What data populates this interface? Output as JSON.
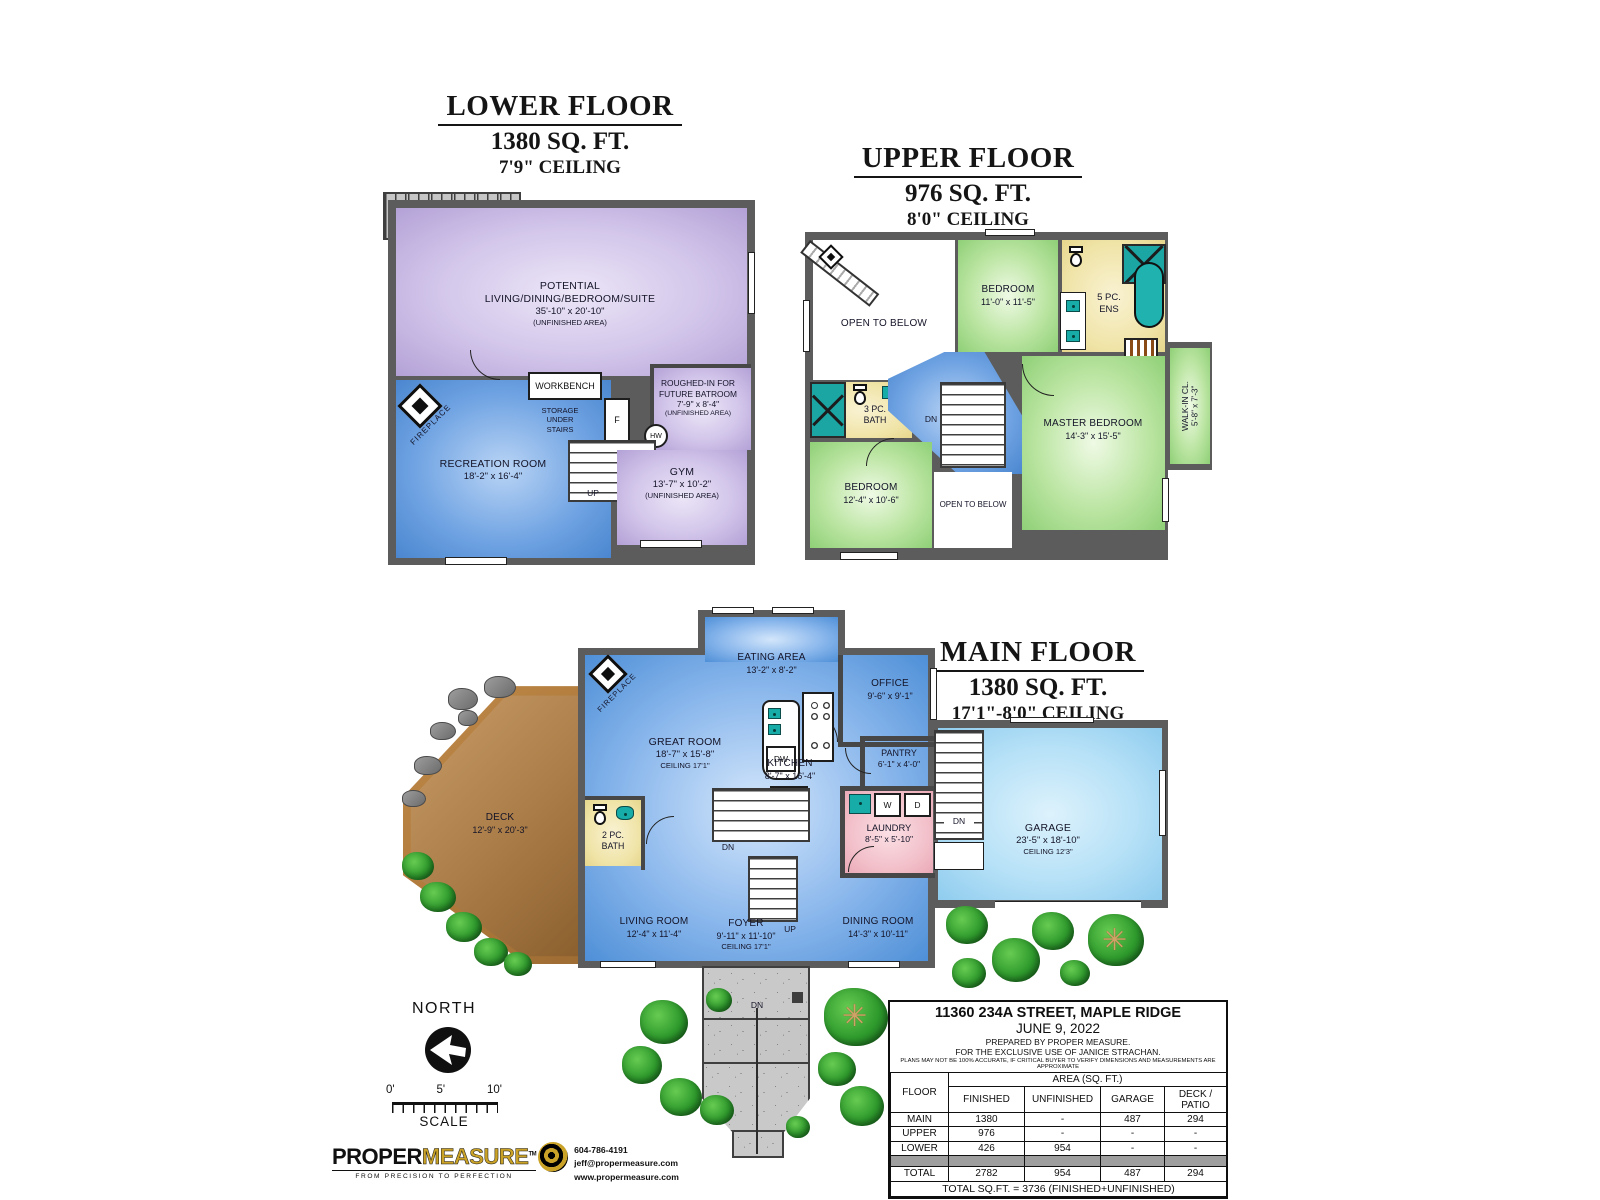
{
  "floors": {
    "lower": {
      "title": "LOWER FLOOR",
      "area": "1380 SQ. FT.",
      "ceiling": "7'9\" CEILING",
      "rooms": {
        "potential": {
          "l1": "POTENTIAL",
          "l2": "LIVING/DINING/BEDROOM/SUITE",
          "dims": "35'-10\" x 20'-10\"",
          "note": "(UNFINISHED AREA)"
        },
        "roughed_in": {
          "l1": "ROUGHED-IN FOR",
          "l2": "FUTURE BATROOM",
          "dims": "7'-9\" x 8'-4\"",
          "note": "(UNFINISHED AREA)"
        },
        "workbench": "WORKBENCH",
        "storage": {
          "l1": "STORAGE",
          "l2": "UNDER",
          "l3": "STAIRS"
        },
        "recreation": {
          "name": "RECREATION ROOM",
          "dims": "18'-2\" x 16'-4\""
        },
        "gym": {
          "name": "GYM",
          "dims": "13'-7\" x 10'-2\"",
          "note": "(UNFINISHED AREA)"
        }
      },
      "labels": {
        "up_exterior": "UP",
        "up_interior": "UP",
        "freezer": "F",
        "hot_water": "HW",
        "fireplace": "FIREPLACE"
      }
    },
    "upper": {
      "title": "UPPER FLOOR",
      "area": "976 SQ. FT.",
      "ceiling": "8'0\" CEILING",
      "rooms": {
        "open_below_1": "OPEN TO BELOW",
        "bedroom_1": {
          "name": "BEDROOM",
          "dims": "11'-0\" x 11'-5\""
        },
        "ensuite": {
          "l1": "5 PC.",
          "l2": "ENS"
        },
        "walk_in": {
          "name": "WALK-IN CL.",
          "dims": "5'-8\" x 7'-3\""
        },
        "master": {
          "name": "MASTER BEDROOM",
          "dims": "14'-3\" x 15'-5\""
        },
        "bath_3pc": {
          "l1": "3 PC.",
          "l2": "BATH"
        },
        "bedroom_2": {
          "name": "BEDROOM",
          "dims": "12'-4\" x 10'-6\""
        },
        "open_below_2": "OPEN TO BELOW"
      },
      "labels": {
        "down": "DN"
      }
    },
    "main": {
      "title": "MAIN FLOOR",
      "area": "1380 SQ. FT.",
      "ceiling": "17'1\"-8'0\" CEILING",
      "rooms": {
        "eating": {
          "name": "EATING AREA",
          "dims": "13'-2\" x 8'-2\""
        },
        "office": {
          "name": "OFFICE",
          "dims": "9'-6\" x 9'-1\""
        },
        "great": {
          "name": "GREAT ROOM",
          "dims": "18'-7\" x 15'-8\"",
          "ceil": "CEILING 17'1\""
        },
        "kitchen": {
          "name": "KITCHEN",
          "dims": "8'-7\" x 16'-4\""
        },
        "pantry": {
          "name": "PANTRY",
          "dims": "6'-1\" x 4'-0\""
        },
        "laundry": {
          "name": "LAUNDRY",
          "dims": "8'-5\" x 5'-10\""
        },
        "garage": {
          "name": "GARAGE",
          "dims": "23'-5\" x 18'-10\"",
          "ceil": "CEILING 12'3\""
        },
        "living": {
          "name": "LIVING ROOM",
          "dims": "12'-4\" x 11'-4\""
        },
        "foyer": {
          "name": "FOYER",
          "dims": "9'-11\" x 11'-10\"",
          "ceil": "CEILING 17'1\""
        },
        "dining": {
          "name": "DINING ROOM",
          "dims": "14'-3\" x 10'-11\""
        },
        "bath_2pc": {
          "l1": "2 PC.",
          "l2": "BATH"
        },
        "deck": {
          "name": "DECK",
          "dims": "12'-9\" x 20'-3\""
        }
      },
      "labels": {
        "fridge": "FR",
        "dishwasher": "DW",
        "washer": "W",
        "dryer": "D",
        "dn_basement": "DN",
        "up_stairs": "UP",
        "dn_garage": "DN",
        "dn_entry": "DN",
        "fireplace": "FIREPLACE"
      }
    }
  },
  "compass": {
    "label": "NORTH"
  },
  "scale_bar": {
    "t0": "0'",
    "t5": "5'",
    "t10": "10'",
    "caption": "SCALE"
  },
  "logo": {
    "name1": "PROPER",
    "name2": "MEASURE",
    "tm": "TM",
    "tagline": "FROM PRECISION TO PERFECTION",
    "phone": "604-786-4191",
    "email": "jeff@propermeasure.com",
    "web": "www.propermeasure.com"
  },
  "info_table": {
    "address": "11360 234A STREET, MAPLE RIDGE",
    "date": "JUNE 9, 2022",
    "prepared": "PREPARED BY PROPER MEASURE.",
    "exclusive": "FOR THE EXCLUSIVE USE OF JANICE STRACHAN.",
    "disclaimer": "PLANS MAY NOT BE 100% ACCURATE, IF CRITICAL BUYER TO VERIFY DIMENSIONS AND MEASUREMENTS ARE APPROXIMATE",
    "floor_col": "FLOOR",
    "area_group": "AREA (SQ. FT.)",
    "columns": [
      "FINISHED",
      "UNFINISHED",
      "GARAGE",
      "DECK / PATIO"
    ],
    "rows": [
      [
        "MAIN",
        "1380",
        "-",
        "487",
        "294"
      ],
      [
        "UPPER",
        "976",
        "-",
        "-",
        "-"
      ],
      [
        "LOWER",
        "426",
        "954",
        "-",
        "-"
      ]
    ],
    "total_row": [
      "TOTAL",
      "2782",
      "954",
      "487",
      "294"
    ],
    "footer": "TOTAL SQ.FT. = 3736 (FINISHED+UNFINISHED)"
  },
  "colors": {
    "wall": "#5c5c5c",
    "blue_room": "#4e8fd7",
    "purple_room": "#c3b4e0",
    "green_room": "#8fd077",
    "yellow_room": "#efe3a6",
    "pink_room": "#f0bcc6",
    "garage_room": "#a7d9f2",
    "deck": "#b5813f",
    "fixture_teal": "#17aca8",
    "tree_green": "#2e9b33"
  }
}
